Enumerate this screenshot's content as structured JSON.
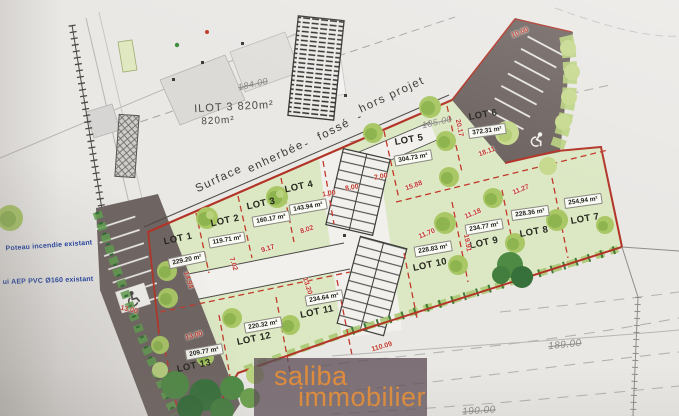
{
  "labels": {
    "ilot": "ILOT 3 820m²",
    "ilot_area": "820m²",
    "note_parts": [
      "Surface",
      "enherbée",
      "-",
      "fossé",
      "-",
      "hors projet"
    ],
    "poteau": "Poteau incendie existant",
    "aep": "ui AEP PVC Ø160 existant"
  },
  "lots": [
    {
      "name": "LOT 1",
      "area": "229.20 m²"
    },
    {
      "name": "LOT 2",
      "area": "119.71 m²"
    },
    {
      "name": "LOT 3",
      "area": "160.17 m²"
    },
    {
      "name": "LOT 4",
      "area": "143.94 m²"
    },
    {
      "name": "LOT 5",
      "area": "304.73 m²"
    },
    {
      "name": "LOT 6",
      "area": "372.31 m²"
    },
    {
      "name": "LOT 7",
      "area": "254,94 m²"
    },
    {
      "name": "LOT 8",
      "area": "228.36 m²"
    },
    {
      "name": "LOT 9",
      "area": "234.77 m²"
    },
    {
      "name": "LOT 10",
      "area": "228.83 m²"
    },
    {
      "name": "LOT 11",
      "area": "234.64 m²"
    },
    {
      "name": "LOT 12",
      "area": "220.32 m²"
    },
    {
      "name": "LOT 13",
      "area": "209.77 m²"
    }
  ],
  "dims": [
    "20.17",
    "18.11",
    "15.88",
    "11.27",
    "11.18",
    "11.70",
    "19.91",
    "9.17",
    "8.02",
    "7.02",
    "14.94",
    "13.20",
    "8.00",
    "2.00",
    "1.00",
    "13.00",
    "13.00",
    "110.09",
    "10.00"
  ],
  "contours": [
    "184.00",
    "185.00",
    "189.00",
    "190.00"
  ],
  "watermark": {
    "line1": "saliba",
    "line2": "immobilier"
  },
  "colors": {
    "boundary_red": "#b23427",
    "lot_green": "#dce8c4",
    "road_gray": "#6e6461",
    "annotation_blue": "#1d3f9e",
    "watermark_orange": "#e08c3a"
  }
}
